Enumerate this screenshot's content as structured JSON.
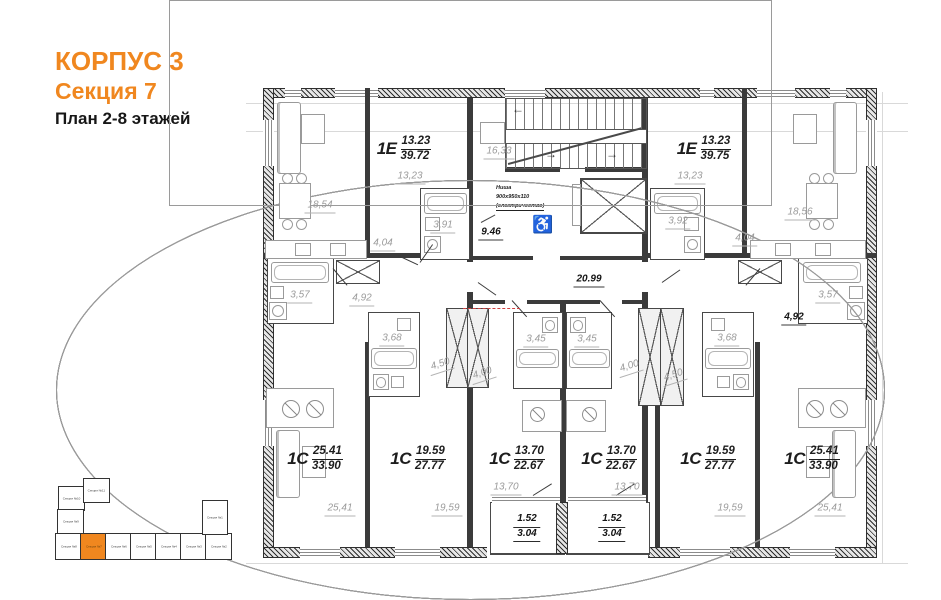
{
  "title": {
    "building": "КОРПУС 3",
    "section": "Секция 7",
    "plan": "План 2-8 этажей"
  },
  "colors": {
    "accent": "#F0871F"
  },
  "apartments": [
    {
      "type": "1Е",
      "living": "13.23",
      "total": "39.72"
    },
    {
      "type": "1Е",
      "living": "13.23",
      "total": "39.75"
    },
    {
      "type": "1С",
      "living": "25.41",
      "total": "33.90"
    },
    {
      "type": "1С",
      "living": "19.59",
      "total": "27.77"
    },
    {
      "type": "1С",
      "living": "13.70",
      "total": "22.67"
    },
    {
      "type": "1С",
      "living": "13.70",
      "total": "22.67"
    },
    {
      "type": "1С",
      "living": "19.59",
      "total": "27.77"
    },
    {
      "type": "1С",
      "living": "25.41",
      "total": "33.90"
    }
  ],
  "rooms": {
    "living_left": "18,54",
    "room_left": "13,23",
    "bath_tl": "3,91",
    "hall_tl": "4,04",
    "stair_hall": "16,33",
    "entry_hall": "9.46",
    "corridor": "20.99",
    "room_right": "13,23",
    "bath_tr": "3,92",
    "hall_tr": "4,04",
    "living_right": "18,56",
    "bath_l1": "3,57",
    "hall_l1": "4,92",
    "bath_l2": "3,68",
    "hall_l2": "4,50",
    "hall_l3": "4,00",
    "bath_c1": "3,45",
    "bath_c2": "3,45",
    "hall_r3": "4,00",
    "hall_r2": "4,50",
    "bath_r2": "3,68",
    "hall_r1": "4,92",
    "bath_r1": "3,57",
    "room_bl1": "25,41",
    "room_bl2": "19,59",
    "room_bc1": "13,70",
    "room_bc2": "13,70",
    "room_br2": "19,59",
    "room_br1": "25,41",
    "balcony_half": "1.52",
    "balcony_full": "3.04"
  },
  "niche": {
    "l1": "Ниша",
    "l2": "900х950х110",
    "l3": "(электричество)"
  },
  "stairs": {
    "arrow_up": "←",
    "arrow_dn": "→"
  },
  "symbols": {
    "wheelchair": "♿"
  },
  "minimap": {
    "sections": [
      {
        "label": "Секция №10"
      },
      {
        "label": "Секция №11"
      },
      {
        "label": "Секция №9"
      },
      {
        "label": "Секция №8"
      },
      {
        "label": "Секция №7"
      },
      {
        "label": "Секция №6"
      },
      {
        "label": "Секция №5"
      },
      {
        "label": "Секция №4"
      },
      {
        "label": "Секция №3"
      },
      {
        "label": "Секция №2"
      },
      {
        "label": "Секция №1"
      }
    ],
    "highlighted": "Секция №7"
  }
}
